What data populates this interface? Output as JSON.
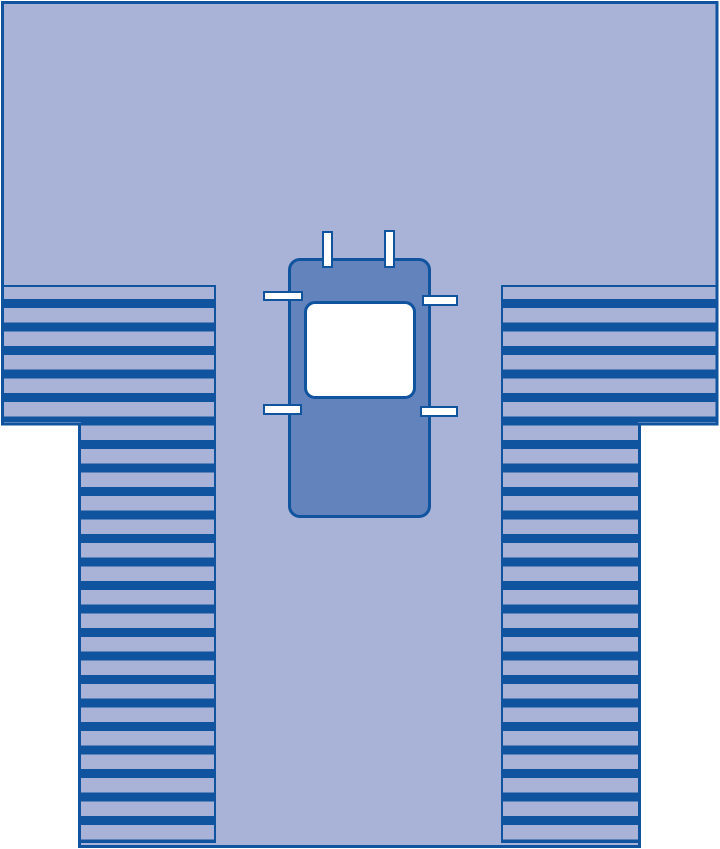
{
  "illustration": {
    "subject": "surgical-drape",
    "text_labels": [],
    "colors": {
      "background": "#ffffff",
      "drape_fill": "#a8b3d7",
      "stripe": "#10539e",
      "outline": "#10539e",
      "panel_fill": "#6383bd",
      "tab_fill": "#ffffff",
      "window_fill": "#ffffff"
    },
    "fanfold": {
      "side_count": 2,
      "stripe_period_px": 23.5,
      "stripe_thickness_px": 9
    },
    "tabs": {
      "count": 6
    }
  }
}
